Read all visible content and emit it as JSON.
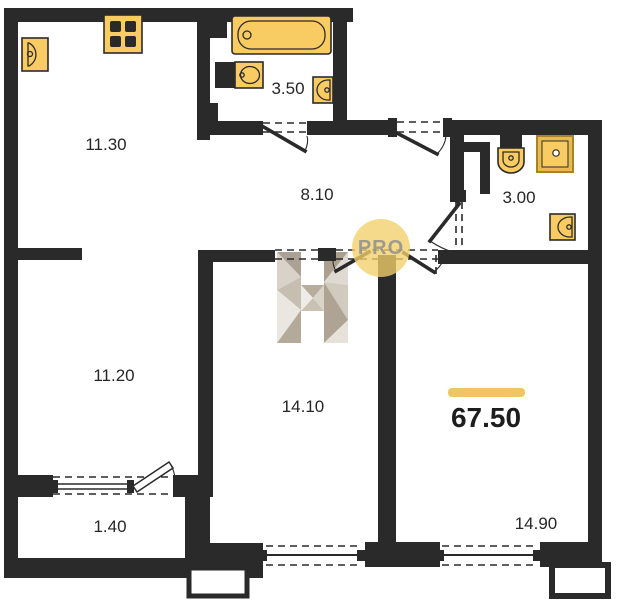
{
  "title": "Apartment floor plan",
  "plan": {
    "total_area": "67.50",
    "rooms": [
      {
        "name": "kitchen-living-room",
        "area": "11.30"
      },
      {
        "name": "bathroom",
        "area": "3.50"
      },
      {
        "name": "hallway",
        "area": "8.10"
      },
      {
        "name": "wc",
        "area": "3.00"
      },
      {
        "name": "room-left",
        "area": "11.20"
      },
      {
        "name": "room-middle",
        "area": "14.10"
      },
      {
        "name": "balcony",
        "area": "1.40"
      },
      {
        "name": "room-right",
        "area": "14.90"
      }
    ],
    "fixtures": [
      "kitchen-sink-icon",
      "stove-icon",
      "bathtub-icon",
      "bathroom-sink-icon",
      "bathroom-wall-sink-icon",
      "toilet-icon",
      "shower-icon",
      "wc-sink-icon"
    ]
  },
  "watermark": {
    "badge_text": "PRO",
    "letter": "H"
  },
  "colors": {
    "wall": "#2a2a2a",
    "fixture_fill": "#f8cb63",
    "fixture_stroke": "#2b2b2b",
    "shower_border": "#a8832a",
    "accent_bar": "#efc566",
    "badge_fill": "#f3d06a",
    "badge_text_color": "#8f8f8f",
    "label_color": "#262626",
    "background": "#ffffff"
  }
}
